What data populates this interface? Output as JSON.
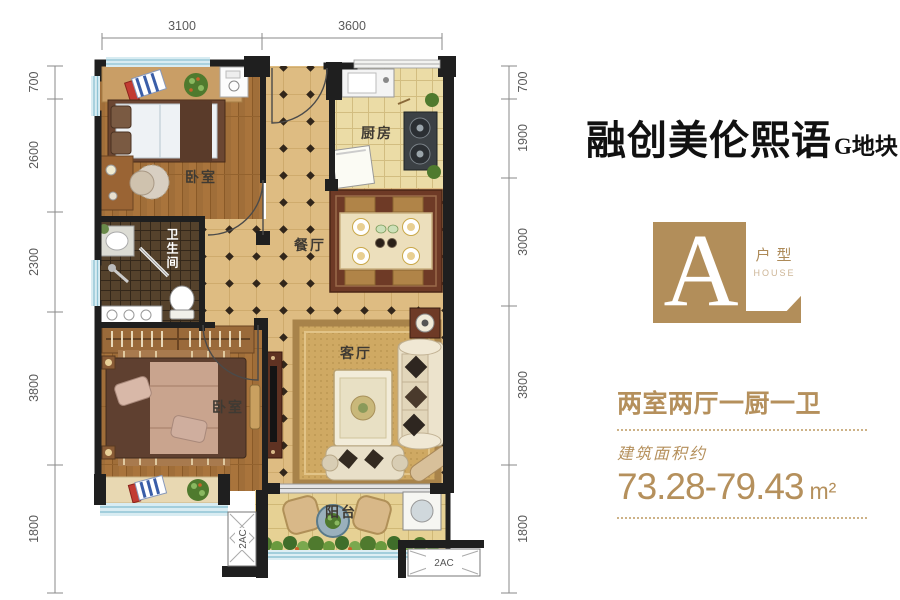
{
  "header": {
    "title": "融创美伦熙语",
    "subtitle": "G地块"
  },
  "badge": {
    "letter": "A",
    "type_label": "户型",
    "type_label_en": "HOUSE",
    "bg_color": "#b28e5a",
    "accent_color": "#b5905c"
  },
  "info": {
    "layout": "两室两厅一厨一卫",
    "area_label": "建筑面积约",
    "area_value": "73.28-79.43",
    "area_unit": "m²"
  },
  "plan": {
    "rooms": {
      "bedroom": "卧室",
      "kitchen": "厨房",
      "dining": "餐厅",
      "bathroom": "卫生间",
      "living": "客厅",
      "balcony": "阳台"
    },
    "ac_label": "2AC",
    "dimensions": {
      "top": [
        "3100",
        "3600"
      ],
      "left": [
        "700",
        "2600",
        "2300",
        "3800",
        "1800"
      ],
      "right": [
        "700",
        "1900",
        "3000",
        "3800",
        "1800"
      ]
    }
  }
}
